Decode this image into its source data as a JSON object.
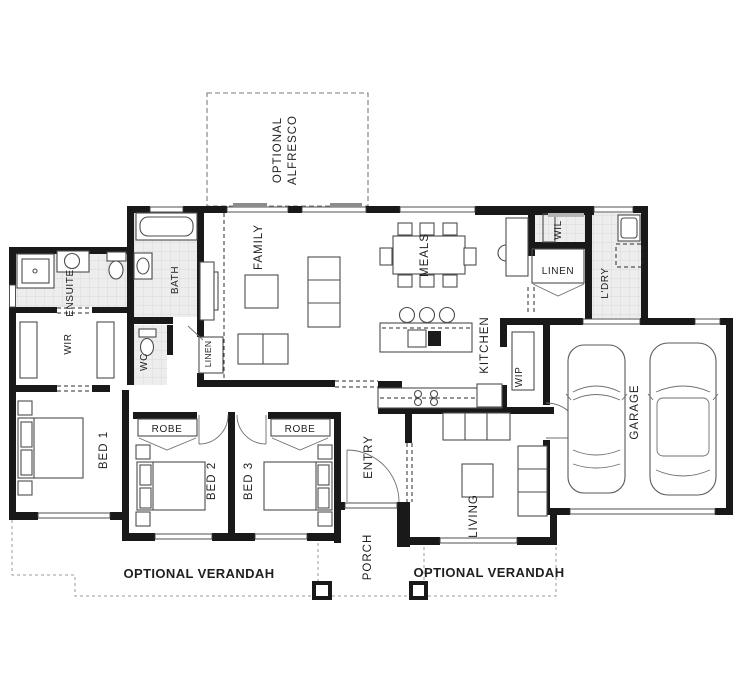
{
  "meta": {
    "type": "floor-plan"
  },
  "colors": {
    "background": "#ffffff",
    "wall": "#191919",
    "furniture_line": "#4d4d4d",
    "tile_fill": "#ededed",
    "tile_grid": "#d9d9d9",
    "optional_dash": "#7a7a7a",
    "verandah_dash": "#9b9b9b",
    "text": "#1f1f1f"
  },
  "labels": {
    "optional_line": "OPTIONAL",
    "alfresco_line": "ALFRESCO",
    "family": "FAMILY",
    "meals": "MEALS",
    "kitchen": "KITCHEN",
    "wip": "WIP",
    "wil": "WIL",
    "linen_hall": "LINEN",
    "laundry": "L'DRY",
    "garage": "GARAGE",
    "ensuite": "ENSUITE",
    "bath": "BATH",
    "wc": "WC",
    "wir": "WIR",
    "linen_family": "LINEN",
    "bed1": "BED 1",
    "bed2": "BED 2",
    "bed3": "BED 3",
    "robe_bed2": "ROBE",
    "robe_bed3": "ROBE",
    "entry": "ENTRY",
    "living": "LIVING",
    "porch": "PORCH",
    "verandah_left": "OPTIONAL VERANDAH",
    "verandah_right": "OPTIONAL VERANDAH"
  }
}
